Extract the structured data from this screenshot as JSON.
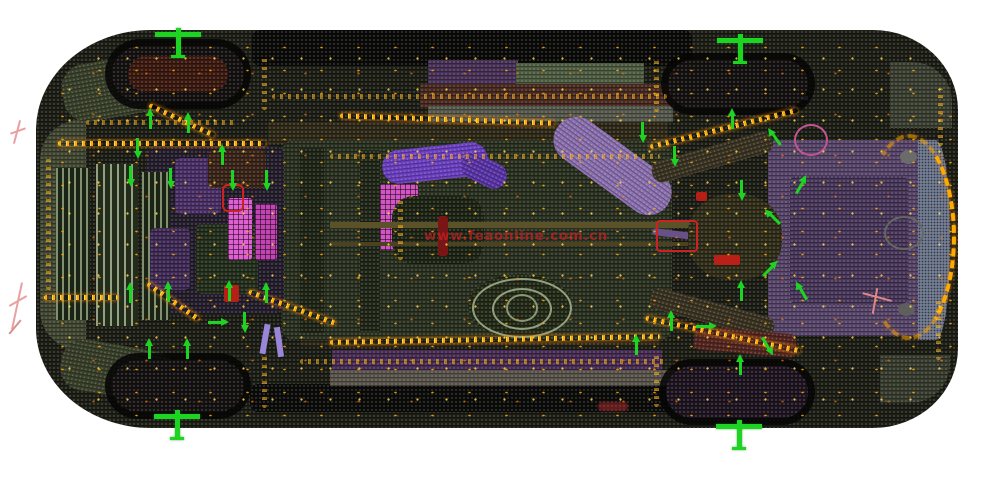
{
  "watermark": {
    "text": "www.feaonline.com.cn"
  },
  "palette": {
    "bg": "#ffffff",
    "green": "#1ed422",
    "weld1": "#ffaa00",
    "weld2": "#ffd34d",
    "watermark": "rgba(204,34,34,0.82)"
  },
  "scene": {
    "parts": [
      {
        "n": "car-body-shell",
        "x": 36,
        "y": 30,
        "w": 922,
        "h": 398,
        "bg": "#1c1d15",
        "cls": "mesh",
        "rad": "115px 85px 85px 115px / 100px 80px 80px 100px"
      },
      {
        "n": "front-nose-panel",
        "x": 40,
        "y": 120,
        "w": 46,
        "h": 230,
        "bg": "#3f4530",
        "cls": "mesh",
        "rad": "40px 0 0 40px"
      },
      {
        "n": "front-corner-top-panel",
        "x": 62,
        "y": 58,
        "w": 115,
        "h": 58,
        "bg": "#39402a",
        "cls": "mesh",
        "rot": -10,
        "rad": 24
      },
      {
        "n": "front-corner-bottom-panel",
        "x": 60,
        "y": 345,
        "w": 115,
        "h": 52,
        "bg": "#383f29",
        "cls": "mesh",
        "rot": 10,
        "rad": 24
      },
      {
        "n": "rear-corner-top-panel",
        "x": 890,
        "y": 62,
        "w": 62,
        "h": 66,
        "bg": "#3a3e31",
        "cls": "mesh",
        "rad": "0 40px 0 0"
      },
      {
        "n": "rear-corner-bottom-panel",
        "x": 880,
        "y": 355,
        "w": 70,
        "h": 48,
        "bg": "#373b2e",
        "cls": "mesh",
        "rad": "0 0 40px 0"
      },
      {
        "n": "hood-edge-black-band",
        "x": 252,
        "y": 30,
        "w": 440,
        "h": 36,
        "bg": "#0a0a09",
        "cls": "mesh",
        "rad": 8
      },
      {
        "n": "lower-edge-black-band",
        "x": 250,
        "y": 384,
        "w": 430,
        "h": 28,
        "bg": "#0b0b0a",
        "cls": "mesh",
        "rad": 8
      },
      {
        "n": "upper-sill-purple-strip",
        "x": 428,
        "y": 60,
        "w": 90,
        "h": 24,
        "bg": "#463055",
        "cls": "mesh"
      },
      {
        "n": "upper-sill-green-strip",
        "x": 516,
        "y": 63,
        "w": 128,
        "h": 22,
        "bg": "#4c5a40",
        "cls": "mesh"
      },
      {
        "n": "upper-sill-maroon-strip",
        "x": 420,
        "y": 84,
        "w": 255,
        "h": 24,
        "bg": "#47291f",
        "cls": "mesh"
      },
      {
        "n": "upper-sill-gray-strip",
        "x": 428,
        "y": 106,
        "w": 245,
        "h": 16,
        "bg": "#53564a",
        "cls": "mesh"
      },
      {
        "n": "lower-sill-purple-strip",
        "x": 332,
        "y": 350,
        "w": 330,
        "h": 22,
        "bg": "#452a51",
        "cls": "mesh"
      },
      {
        "n": "lower-sill-gray-strip",
        "x": 330,
        "y": 370,
        "w": 345,
        "h": 16,
        "bg": "#575249",
        "cls": "mesh"
      },
      {
        "n": "upper-side-rail",
        "x": 268,
        "y": 122,
        "w": 400,
        "h": 22,
        "bg": "#2e2817",
        "cls": "mesh"
      },
      {
        "n": "lower-side-rail",
        "x": 300,
        "y": 330,
        "w": 360,
        "h": 16,
        "bg": "#2c2615",
        "cls": "mesh"
      },
      {
        "n": "center-floor-pan",
        "x": 282,
        "y": 140,
        "w": 390,
        "h": 200,
        "bg": "#2a3020",
        "cls": "mesh",
        "rad": 12
      },
      {
        "n": "floor-longitudinal-rail-1",
        "x": 300,
        "y": 148,
        "w": 24,
        "h": 185,
        "bg": "#1e2416",
        "cls": "mesh"
      },
      {
        "n": "floor-longitudinal-rail-2",
        "x": 360,
        "y": 150,
        "w": 20,
        "h": 182,
        "bg": "#202618",
        "cls": "mesh"
      },
      {
        "n": "engine-block-mass",
        "x": 146,
        "y": 146,
        "w": 138,
        "h": 168,
        "bg": "#241d2b",
        "cls": "mesh",
        "rad": 10
      },
      {
        "n": "radiator-core-1",
        "x": 56,
        "y": 168,
        "w": 34,
        "h": 152,
        "cls": "stripes"
      },
      {
        "n": "radiator-core-2",
        "x": 96,
        "y": 164,
        "w": 42,
        "h": 162,
        "cls": "stripes2"
      },
      {
        "n": "radiator-core-3",
        "x": 142,
        "y": 172,
        "w": 28,
        "h": 148,
        "cls": "stripes"
      },
      {
        "n": "engine-purple-component-1",
        "x": 175,
        "y": 158,
        "w": 46,
        "h": 56,
        "bg": "#4a2f66",
        "cls": "mesh",
        "rad": 6
      },
      {
        "n": "engine-purple-component-2",
        "x": 150,
        "y": 228,
        "w": 40,
        "h": 62,
        "bg": "#3f2a55",
        "cls": "mesh",
        "rad": 6
      },
      {
        "n": "engine-green-component",
        "x": 196,
        "y": 224,
        "w": 62,
        "h": 70,
        "bg": "#232e1c",
        "cls": "mesh",
        "rad": 6
      },
      {
        "n": "engine-brown-component",
        "x": 208,
        "y": 150,
        "w": 58,
        "h": 38,
        "bg": "#3a2418",
        "cls": "mesh",
        "rad": 6
      },
      {
        "n": "magenta-reservoir-1",
        "x": 228,
        "y": 198,
        "w": 24,
        "h": 62,
        "bg": "#e05fd2",
        "cls": "grid",
        "rad": 3
      },
      {
        "n": "magenta-reservoir-2",
        "x": 255,
        "y": 204,
        "w": 22,
        "h": 56,
        "bg": "#c343b4",
        "cls": "grid",
        "rad": 3
      },
      {
        "n": "magenta-mid-panel",
        "x": 380,
        "y": 184,
        "w": 38,
        "h": 66,
        "bg": "#d355c4",
        "cls": "grid",
        "rad": 3
      },
      {
        "n": "gearbox-mass",
        "x": 392,
        "y": 196,
        "w": 92,
        "h": 68,
        "bg": "#1d2415",
        "cls": "mesh",
        "rad": 22
      },
      {
        "n": "purple-exhaust-pipe-front",
        "x": 382,
        "y": 146,
        "w": 106,
        "h": 34,
        "bg": "#6a3fc0",
        "cls": "mesh",
        "rot": -6,
        "rad": 17
      },
      {
        "n": "purple-exhaust-elbow",
        "x": 460,
        "y": 158,
        "w": 48,
        "h": 26,
        "bg": "#5a34a8",
        "cls": "mesh",
        "rot": 26,
        "rad": 13
      },
      {
        "n": "driveshaft-upper",
        "x": 330,
        "y": 222,
        "w": 360,
        "h": 6,
        "bg": "#5c522a"
      },
      {
        "n": "driveshaft-lower",
        "x": 330,
        "y": 242,
        "w": 360,
        "h": 4,
        "bg": "#4a4220"
      },
      {
        "n": "exhaust-rear-pipe",
        "x": 652,
        "y": 236,
        "w": 132,
        "h": 7,
        "bg": "#6a5088",
        "rot": 7,
        "rad": 3
      },
      {
        "n": "muffler-cylinder",
        "x": 545,
        "y": 143,
        "w": 135,
        "h": 46,
        "bg": "#8a6fae",
        "cls": "mesh",
        "rot": 36,
        "rad": 23
      },
      {
        "n": "fuel-tank-base",
        "x": 468,
        "y": 274,
        "w": 104,
        "h": 64,
        "bg": "#222a17",
        "cls": "mesh",
        "rad": "50%"
      },
      {
        "n": "fuel-tank-ring-outer",
        "x": 472,
        "y": 278,
        "w": 96,
        "h": 56,
        "bd": "#93a07e",
        "rad": "50%"
      },
      {
        "n": "fuel-tank-ring-mid",
        "x": 492,
        "y": 288,
        "w": 56,
        "h": 38,
        "bd": "#93a07e",
        "rad": "50%"
      },
      {
        "n": "fuel-tank-ring-inner",
        "x": 506,
        "y": 294,
        "w": 28,
        "h": 24,
        "bd": "#8a9776",
        "rad": "50%"
      },
      {
        "n": "rear-floor-purple-pan",
        "x": 768,
        "y": 140,
        "w": 160,
        "h": 196,
        "bg": "#564468",
        "cls": "mesh",
        "rad": 10
      },
      {
        "n": "rear-floor-inner-panel",
        "x": 790,
        "y": 175,
        "w": 118,
        "h": 130,
        "bg": "#473659",
        "cls": "mesh",
        "rad": 8
      },
      {
        "n": "rear-axle-differential",
        "x": 688,
        "y": 194,
        "w": 94,
        "h": 86,
        "bg": "#2f2c18",
        "cls": "mesh",
        "rad": "45%"
      },
      {
        "n": "trailing-arm-top",
        "x": 650,
        "y": 146,
        "w": 125,
        "h": 22,
        "bg": "#3a3322",
        "cls": "mesh",
        "rot": -16,
        "rad": 10
      },
      {
        "n": "trailing-arm-bottom",
        "x": 648,
        "y": 302,
        "w": 128,
        "h": 22,
        "bg": "#3a3322",
        "cls": "mesh",
        "rot": 15,
        "rad": 10
      },
      {
        "n": "rear-maroon-member",
        "x": 694,
        "y": 330,
        "w": 102,
        "h": 24,
        "bg": "#53251e",
        "cls": "mesh",
        "rot": 5,
        "rad": 6
      },
      {
        "n": "rear-hatch-outer-band",
        "x": 918,
        "y": 140,
        "w": 32,
        "h": 200,
        "bg": "#747e96",
        "cls": "meshdark",
        "rad": "0 45% 45% 0"
      },
      {
        "n": "rear-hatch-arc-seam",
        "x": 862,
        "y": 134,
        "w": 86,
        "h": 198,
        "cls": "arcseam"
      },
      {
        "n": "rear-gray-grommet-1",
        "x": 900,
        "y": 150,
        "w": 17,
        "h": 14,
        "bg": "#6b6b6b",
        "rad": "50%"
      },
      {
        "n": "rear-gray-grommet-2",
        "x": 898,
        "y": 303,
        "w": 17,
        "h": 13,
        "bg": "#5e5e5e",
        "rad": "50%"
      },
      {
        "n": "spare-wheel-ring",
        "x": 884,
        "y": 216,
        "w": 36,
        "h": 30,
        "bd": "#666666",
        "rad": "50%"
      },
      {
        "n": "pink-bushing-ring",
        "x": 794,
        "y": 124,
        "w": 30,
        "h": 28,
        "bd": "#c05590",
        "rad": "50%"
      },
      {
        "n": "lavender-link-1",
        "x": 780,
        "y": 96,
        "w": 28,
        "h": 4,
        "bg": "#8f7ad0"
      },
      {
        "n": "lavender-link-2",
        "x": 791,
        "y": 88,
        "w": 4,
        "h": 24,
        "bg": "#8f7ad0"
      },
      {
        "n": "lavender-strut-1",
        "x": 262,
        "y": 324,
        "w": 6,
        "h": 30,
        "bg": "#9a86d8",
        "rot": 10
      },
      {
        "n": "lavender-strut-2",
        "x": 276,
        "y": 327,
        "w": 6,
        "h": 30,
        "bg": "#9a86d8",
        "rot": -8
      },
      {
        "n": "red-rear-arm",
        "x": 656,
        "y": 220,
        "w": 38,
        "h": 28,
        "bd": "#cc2222",
        "rad": 4
      },
      {
        "n": "red-rear-bar",
        "x": 714,
        "y": 255,
        "w": 26,
        "h": 10,
        "bg": "#bb2018",
        "rad": 2
      },
      {
        "n": "red-rear-dot",
        "x": 696,
        "y": 192,
        "w": 11,
        "h": 9,
        "bg": "#b51f15",
        "rad": 2
      },
      {
        "n": "red-front-bracket",
        "x": 222,
        "y": 184,
        "w": 18,
        "h": 24,
        "bd": "#cc2222",
        "rad": 6
      },
      {
        "n": "red-front-clamp",
        "x": 224,
        "y": 285,
        "w": 15,
        "h": 17,
        "bg": "#b51f15",
        "rad": 2
      },
      {
        "n": "red-center-link",
        "x": 438,
        "y": 216,
        "w": 10,
        "h": 40,
        "bg": "#7a1515",
        "rad": 3
      },
      {
        "n": "tire-front-top",
        "x": 112,
        "y": 46,
        "w": 132,
        "h": 56,
        "cls": "tire mesh",
        "rad": 28
      },
      {
        "n": "tire-front-top-tread",
        "x": 128,
        "y": 56,
        "w": 100,
        "h": 36,
        "bg": "#3b190f",
        "cls": "mesh",
        "rad": 18
      },
      {
        "n": "tire-front-bottom",
        "x": 112,
        "y": 360,
        "w": 132,
        "h": 52,
        "cls": "tire mesh",
        "rad": 26
      },
      {
        "n": "tire-rear-top",
        "x": 668,
        "y": 60,
        "w": 140,
        "h": 48,
        "cls": "tire mesh",
        "rad": 24
      },
      {
        "n": "tire-rear-bottom",
        "x": 666,
        "y": 366,
        "w": 142,
        "h": 52,
        "bg": "#1d1420",
        "cls": "tire mesh",
        "rad": 26
      },
      {
        "n": "pink-wire-marker-front-a",
        "x": 16,
        "y": 120,
        "w": 2,
        "h": 24,
        "bg": "#e8a0a0",
        "rot": 15
      },
      {
        "n": "pink-wire-marker-front-b",
        "x": 10,
        "y": 130,
        "w": 16,
        "h": 2,
        "bg": "#e8a0a0",
        "rot": -20
      },
      {
        "n": "pink-wire-marker-mid-a",
        "x": 16,
        "y": 282,
        "w": 2,
        "h": 48,
        "bg": "#e8a0a0",
        "rot": 12
      },
      {
        "n": "pink-wire-marker-mid-b",
        "x": 8,
        "y": 300,
        "w": 20,
        "h": 2,
        "bg": "#e8a0a0",
        "rot": -30
      },
      {
        "n": "pink-wire-marker-mid-c",
        "x": 14,
        "y": 318,
        "w": 2,
        "h": 18,
        "bg": "#d89090",
        "rot": 40
      },
      {
        "n": "pink-wire-marker-rear-a",
        "x": 862,
        "y": 296,
        "w": 30,
        "h": 2,
        "bg": "#dd8888",
        "rot": 15
      },
      {
        "n": "pink-wire-marker-rear-b",
        "x": 874,
        "y": 288,
        "w": 2,
        "h": 26,
        "bg": "#dd8888",
        "rot": 10
      },
      {
        "n": "watermark-smudge",
        "x": 598,
        "y": 402,
        "w": 30,
        "h": 9,
        "bg": "#cc3333",
        "cls": "smudge",
        "op": 0.45,
        "rad": 4
      },
      {
        "n": "weld-speckle-field",
        "x": 44,
        "y": 36,
        "w": 908,
        "h": 388,
        "cls": "speckle",
        "rad": "115px 85px 85px 115px / 100px 80px 80px 100px"
      }
    ],
    "seams": [
      {
        "x": 340,
        "y": 117,
        "len": 215,
        "rot": 2,
        "dir": "h"
      },
      {
        "x": 272,
        "y": 94,
        "len": 395,
        "rot": 0,
        "dir": "h",
        "dim": true
      },
      {
        "x": 330,
        "y": 337,
        "len": 330,
        "rot": -1,
        "dir": "h"
      },
      {
        "x": 300,
        "y": 359,
        "len": 365,
        "rot": 0,
        "dir": "h",
        "dim": true
      },
      {
        "x": 330,
        "y": 154,
        "len": 330,
        "rot": 0,
        "dir": "h",
        "dim": true
      },
      {
        "x": 58,
        "y": 141,
        "len": 208,
        "rot": 0,
        "dir": "h"
      },
      {
        "x": 44,
        "y": 295,
        "len": 74,
        "rot": 0,
        "dir": "h"
      },
      {
        "x": 86,
        "y": 120,
        "len": 150,
        "rot": 0,
        "dir": "h",
        "dim": true
      },
      {
        "x": 46,
        "y": 158,
        "len": 132,
        "rot": 0,
        "dir": "v",
        "dim": true
      },
      {
        "x": 262,
        "y": 54,
        "len": 56,
        "rot": 0,
        "dir": "v",
        "dim": true
      },
      {
        "x": 262,
        "y": 352,
        "len": 56,
        "rot": 0,
        "dir": "v",
        "dim": true
      },
      {
        "x": 654,
        "y": 57,
        "len": 55,
        "rot": 0,
        "dir": "v",
        "dim": true
      },
      {
        "x": 654,
        "y": 355,
        "len": 52,
        "rot": 0,
        "dir": "v",
        "dim": true
      },
      {
        "x": 648,
        "y": 126,
        "len": 152,
        "rot": -14,
        "dir": "h"
      },
      {
        "x": 644,
        "y": 332,
        "len": 158,
        "rot": 12,
        "dir": "h"
      },
      {
        "x": 398,
        "y": 198,
        "len": 62,
        "rot": 0,
        "dir": "v",
        "dim": true
      },
      {
        "x": 142,
        "y": 299,
        "len": 62,
        "rot": 35,
        "dir": "h"
      },
      {
        "x": 246,
        "y": 305,
        "len": 92,
        "rot": 20,
        "dir": "h"
      },
      {
        "x": 146,
        "y": 118,
        "len": 72,
        "rot": 25,
        "dir": "h"
      },
      {
        "x": 938,
        "y": 88,
        "len": 58,
        "rot": 0,
        "dir": "v",
        "dim": true
      },
      {
        "x": 936,
        "y": 300,
        "len": 60,
        "rot": 0,
        "dir": "v",
        "dim": true
      }
    ],
    "wheel_crosses": [
      [
        178,
        36
      ],
      [
        740,
        42
      ],
      [
        177,
        418
      ],
      [
        739,
        428
      ]
    ],
    "arrows": [
      [
        146,
        108,
        0
      ],
      [
        184,
        112,
        0
      ],
      [
        133,
        138,
        180
      ],
      [
        218,
        144,
        0
      ],
      [
        126,
        166,
        180
      ],
      [
        166,
        168,
        180
      ],
      [
        228,
        170,
        180
      ],
      [
        262,
        170,
        180
      ],
      [
        126,
        282,
        0
      ],
      [
        164,
        281,
        0
      ],
      [
        225,
        280,
        0
      ],
      [
        262,
        282,
        0
      ],
      [
        214,
        312,
        90
      ],
      [
        240,
        312,
        180
      ],
      [
        145,
        338,
        0
      ],
      [
        183,
        338,
        0
      ],
      [
        638,
        122,
        180
      ],
      [
        670,
        146,
        180
      ],
      [
        728,
        108,
        0
      ],
      [
        770,
        126,
        -35
      ],
      [
        737,
        180,
        180
      ],
      [
        768,
        206,
        -45
      ],
      [
        797,
        174,
        30
      ],
      [
        766,
        258,
        45
      ],
      [
        737,
        280,
        0
      ],
      [
        797,
        280,
        -30
      ],
      [
        667,
        310,
        0
      ],
      [
        702,
        316,
        90
      ],
      [
        763,
        336,
        150
      ],
      [
        736,
        354,
        0
      ],
      [
        632,
        334,
        0
      ]
    ]
  }
}
